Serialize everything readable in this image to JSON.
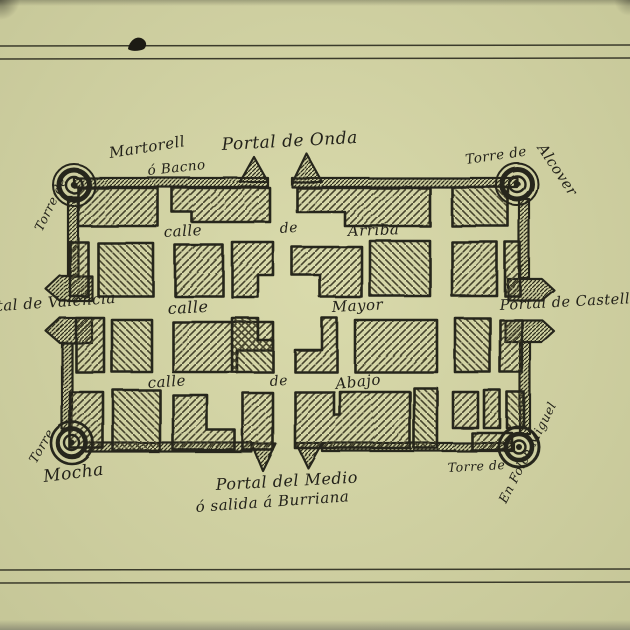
{
  "colors": {
    "paper": "#d5d6a4",
    "ink": "#26251a",
    "hatch": "#46442f",
    "rule": "#3b3b2b"
  },
  "map": {
    "gates": {
      "north": "Portal de Onda",
      "west": "Portal de Valencia",
      "east": "Portal de Castellon",
      "south_line1": "Portal del Medio",
      "south_line2": "ó salida á Burriana"
    },
    "towers": {
      "nw_prefix": "Torre de",
      "nw_name": "Martorell",
      "nw_alias": "ó Bacno",
      "ne_prefix": "Torre de",
      "ne_name": "Alcover",
      "sw_prefix": "Torre",
      "sw_name": "Mocha",
      "se_prefix": "Torre de",
      "se_name": "En Folch Miguel"
    },
    "streets": {
      "arriba_word1": "calle",
      "arriba_word2": "de",
      "arriba_word3": "Arriba",
      "mayor_word1": "calle",
      "mayor_word2": "Mayor",
      "abajo_word1": "calle",
      "abajo_word2": "de",
      "abajo_word3": "Abajo"
    }
  }
}
